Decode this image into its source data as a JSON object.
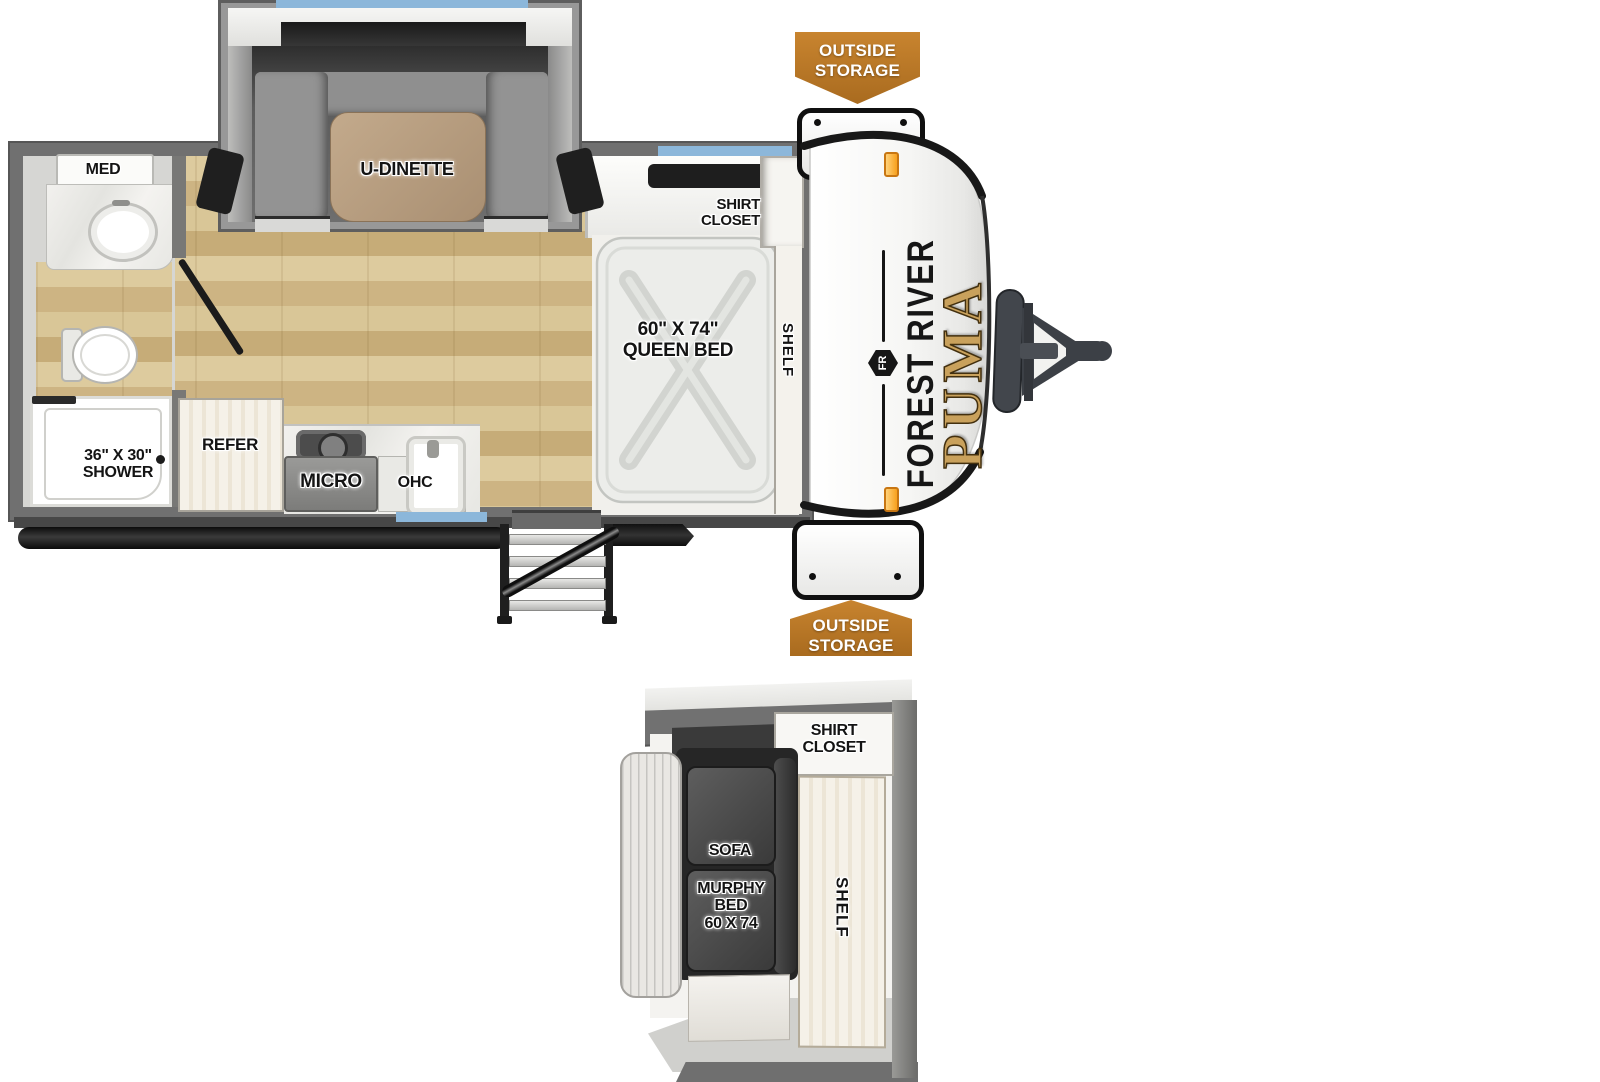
{
  "colors": {
    "wall_gray": "#707070",
    "wood_floor": "#d8c69b",
    "window_blue": "#8cb7da",
    "banner_orange": "#b8782a",
    "brand_gold": "#c9a15c",
    "marker_light_orange": "#f7a01d"
  },
  "main": {
    "bathroom": {
      "med": "MED",
      "shower_size": "36\" X 30\"",
      "shower": "SHOWER"
    },
    "kitchen": {
      "refer": "REFER",
      "micro": "MICRO",
      "ohc": "OHC"
    },
    "dinette": {
      "label": "U-DINETTE"
    },
    "bedroom": {
      "bed_size": "60\" X 74\"",
      "bed": "QUEEN BED",
      "shirt_line1": "SHIRT",
      "shirt_line2": "CLOSET",
      "shelf": "SHELF"
    },
    "exterior": {
      "brand": "FOREST RIVER",
      "model": "PUMA",
      "logo": "FR",
      "storage_top_line1": "OUTSIDE",
      "storage_top_line2": "STORAGE",
      "storage_bottom_line1": "OUTSIDE",
      "storage_bottom_line2": "STORAGE"
    }
  },
  "inset": {
    "shirt_line1": "SHIRT",
    "shirt_line2": "CLOSET",
    "sofa": "SOFA",
    "murphy_line1": "MURPHY",
    "murphy_line2": "BED",
    "murphy_line3": "60 X 74",
    "shelf": "SHELF"
  }
}
